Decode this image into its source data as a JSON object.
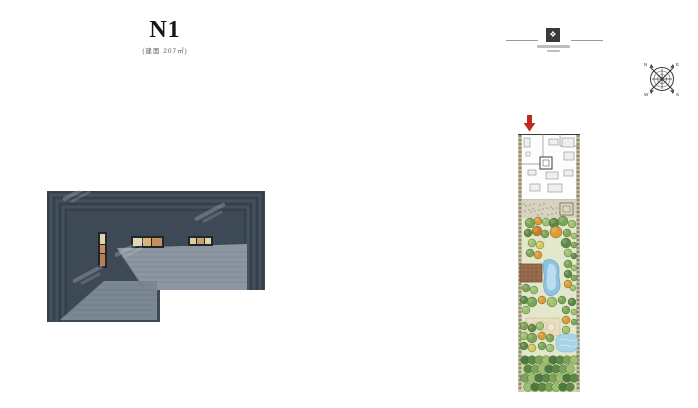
{
  "document": {
    "unit_label": "N1",
    "unit_sublabel": "(建面 207㎡)",
    "logo": {
      "mark": "❖"
    },
    "compass": {
      "n": "N",
      "e": "E",
      "s": "S",
      "w": "W"
    },
    "colors": {
      "roof_dark": "#3e4956",
      "roof_step_dark": "#2d3844",
      "roof_step_light": "#4b5766",
      "roof_plane_light": "#8b96a0",
      "roof_plane_shade": "#79858f",
      "skylight_amber": "#d8b27e",
      "entry_arrow_red": "#c2281c",
      "garden_base": "#e3e8cd",
      "water_blue": "#8ec3e0",
      "hedge_tan": "#cfc6ae"
    }
  }
}
